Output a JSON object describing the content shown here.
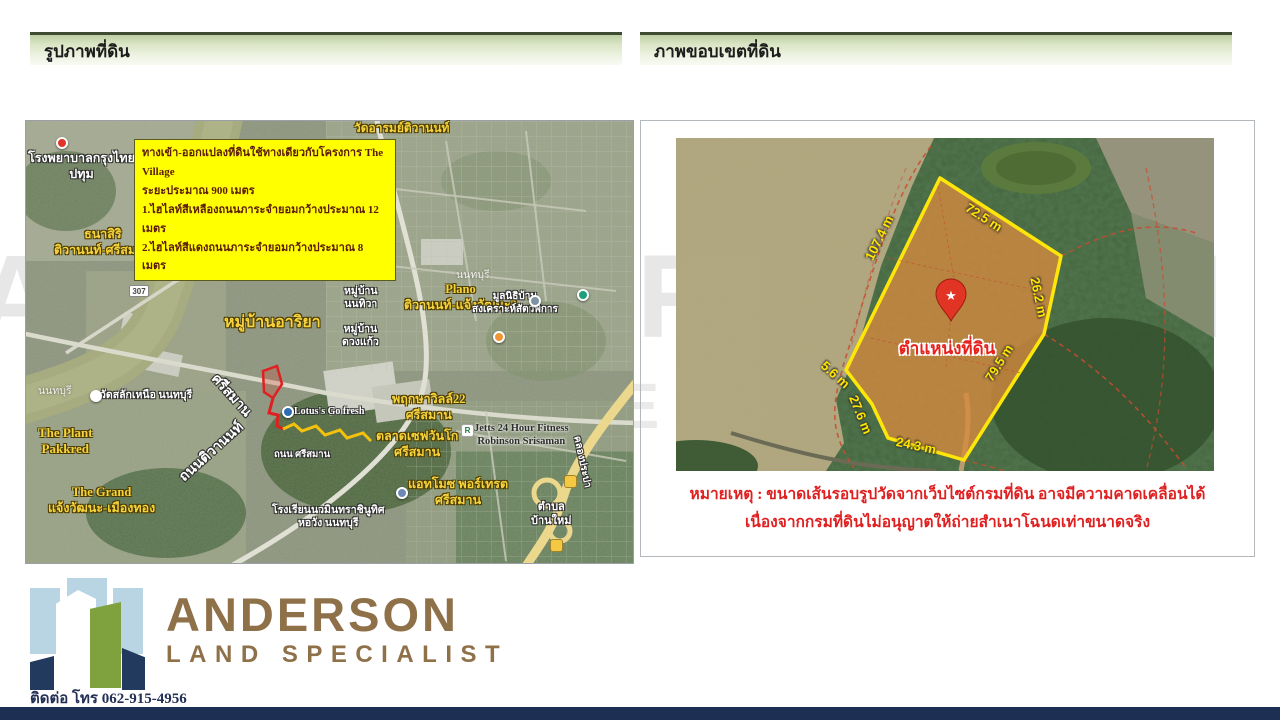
{
  "headers": {
    "left": "รูปภาพที่ดิน",
    "right": "ภาพขอบเขตที่ดิน"
  },
  "map_panel": {
    "annotation": {
      "lines": [
        "ทางเข้า-ออกแปลงที่ดินใช้ทางเดียวกับโครงการ The Village",
        "ระยะประมาณ 900 เมตร",
        "1.ไฮไลท์สีเหลืองถนนภาระจำยอมกว้างประมาณ 12 เมตร",
        "2.ไฮไลท์สีแดงถนนภาระจำยอมกว้างประมาณ 8 เมตร"
      ]
    },
    "labels": [
      {
        "text": "โรงพยาบาลกรุงไทย\nปทุม",
        "x": 2,
        "y": 30,
        "c": "white",
        "s": 12.5
      },
      {
        "text": "วัดอารมย์ติวานนท์",
        "x": 328,
        "y": 0,
        "c": "yellow",
        "s": 12
      },
      {
        "text": "ธนาสิริ\nติวานนท์-ศรีสมาน",
        "x": 28,
        "y": 106,
        "c": "yellow",
        "s": 12.5
      },
      {
        "text": "วัดโพธิ์ทองบน",
        "x": 205,
        "y": 99,
        "c": "yellow",
        "s": 12
      },
      {
        "text": "Plano\nติวานนท์-แจ้งวัฒนะ2",
        "x": 378,
        "y": 161,
        "c": "yellow",
        "s": 12.5
      },
      {
        "text": "หมู่บ้านอาริยา",
        "x": 198,
        "y": 192,
        "c": "yellow",
        "s": 16
      },
      {
        "text": "หมู่บ้าน\nนนทิวา",
        "x": 318,
        "y": 164,
        "c": "white",
        "s": 10.5
      },
      {
        "text": "หมู่บ้าน\nดวงแก้ว",
        "x": 316,
        "y": 202,
        "c": "white",
        "s": 10.5
      },
      {
        "text": "มูลนิธิบ้าน\nสงเคราะห์สัตว์พิการ",
        "x": 446,
        "y": 170,
        "c": "white",
        "s": 10
      },
      {
        "text": "วัดสลักเหนือ นนทบุรี",
        "x": 74,
        "y": 268,
        "c": "white",
        "s": 10.5
      },
      {
        "text": "นนทบุรี",
        "x": 12,
        "y": 264,
        "c": "gray",
        "s": 10.5
      },
      {
        "text": "นนทบุรี",
        "x": 430,
        "y": 148,
        "c": "gray",
        "s": 10.5
      },
      {
        "text": "Lotus's Go fresh",
        "x": 268,
        "y": 285,
        "c": "white",
        "s": 10
      },
      {
        "text": "ถนน ศรีสมาน",
        "x": 248,
        "y": 329,
        "c": "white",
        "s": 9.5
      },
      {
        "text": "The Plant\nPakkred",
        "x": 12,
        "y": 304,
        "c": "yellow",
        "s": 13
      },
      {
        "text": "The Grand\nแจ้งวัฒนะ-เมืองทอง",
        "x": 22,
        "y": 364,
        "c": "yellow",
        "s": 12.5
      },
      {
        "text": "พฤกษาวิลล์22\nศรีสมาน",
        "x": 366,
        "y": 271,
        "c": "yellow",
        "s": 12.5
      },
      {
        "text": "ตลาดเซฟวันโก\nศรีสมาน",
        "x": 350,
        "y": 308,
        "c": "yellow",
        "s": 12.5
      },
      {
        "text": "แอทโมซ พอร์เทรต\nศรีสมาน",
        "x": 382,
        "y": 356,
        "c": "yellow",
        "s": 12.5
      },
      {
        "text": "Jetts 24 Hour Fitness\nRobinson Srisaman",
        "x": 448,
        "y": 301,
        "c": "dark",
        "s": 10.5
      },
      {
        "text": "ตำบล\nบ้านใหม่",
        "x": 505,
        "y": 380,
        "c": "white",
        "s": 11
      },
      {
        "text": "โรงเรียนนวมินทราชินูทิศ\nหอวัง นนทบุรี",
        "x": 246,
        "y": 383,
        "c": "white",
        "s": 10.5
      },
      {
        "text": "ถนนติวานนท์",
        "x": 338,
        "y": 42,
        "c": "white",
        "s": 13,
        "r": 75
      },
      {
        "text": "ศรีสมาน",
        "x": 194,
        "y": 250,
        "c": "white",
        "s": 14,
        "r": 48
      },
      {
        "text": "ถนนติวานนท์",
        "x": 150,
        "y": 352,
        "c": "white",
        "s": 14,
        "r": -42
      },
      {
        "text": "คลองประปา",
        "x": 556,
        "y": 314,
        "c": "white",
        "s": 10,
        "r": 78
      }
    ],
    "markers": [
      {
        "x": 30,
        "y": 16,
        "color": "#e03428",
        "shape": "dot"
      },
      {
        "x": 64,
        "y": 269,
        "color": "#ffffff",
        "shape": "dot"
      },
      {
        "x": 467,
        "y": 210,
        "color": "#f09436",
        "shape": "dot"
      },
      {
        "x": 503,
        "y": 174,
        "color": "#7b93a4",
        "shape": "dot"
      },
      {
        "x": 551,
        "y": 168,
        "color": "#1e9e7a",
        "shape": "dot"
      },
      {
        "x": 370,
        "y": 366,
        "color": "#6e87b8",
        "shape": "dot"
      },
      {
        "x": 256,
        "y": 285,
        "color": "#2e6db4",
        "shape": "dot"
      },
      {
        "x": 538,
        "y": 354,
        "color": "#f5c843",
        "shape": "sq"
      },
      {
        "x": 524,
        "y": 418,
        "color": "#f5c843",
        "shape": "sq"
      },
      {
        "x": 103,
        "y": 164,
        "color": "#ffffff",
        "shape": "rect",
        "label": "307",
        "lc": "#444444"
      },
      {
        "x": 435,
        "y": 303,
        "color": "#ffffff",
        "shape": "sq",
        "label": "R",
        "lc": "#1e7a40"
      }
    ]
  },
  "boundary_panel": {
    "pin_label": "ตำแหน่งที่ดิน",
    "measurements": [
      {
        "text": "72.5 m",
        "x": 295,
        "y": 62,
        "r": 33
      },
      {
        "text": "107.4 m",
        "x": 186,
        "y": 118,
        "r": -64
      },
      {
        "text": "26.2 m",
        "x": 366,
        "y": 138,
        "r": 78
      },
      {
        "text": "79.5 m",
        "x": 306,
        "y": 238,
        "r": -58
      },
      {
        "text": "24.3 m",
        "x": 222,
        "y": 296,
        "r": 12
      },
      {
        "text": "27.6 m",
        "x": 184,
        "y": 255,
        "r": 68
      },
      {
        "text": "5.6 m",
        "x": 152,
        "y": 220,
        "r": 42
      }
    ],
    "note": [
      "หมายเหตุ : ขนาดเส้นรอบรูปวัดจากเว็บไซต์กรมที่ดิน อาจมีความคาดเคลื่อนได้",
      "เนื่องจากกรมที่ดินไม่อนุญาตให้ถ่ายสำเนาโฉนดเท่าขนาดจริง"
    ]
  },
  "branding": {
    "name": "ANDERSON",
    "tagline": "LAND SPECIALIST",
    "contact": "ติดต่อ โทร 062-915-4956",
    "watermark": [
      "ANDERSON",
      "LAND SPECIALIST"
    ]
  },
  "colors": {
    "accent_yellow": "#ffe60a",
    "plot_orange": "#d78b3f",
    "note_red": "#e02020",
    "brand_bronze": "#8f7149",
    "footer_navy": "#1d3053",
    "header_green": "#d9e4c4"
  }
}
